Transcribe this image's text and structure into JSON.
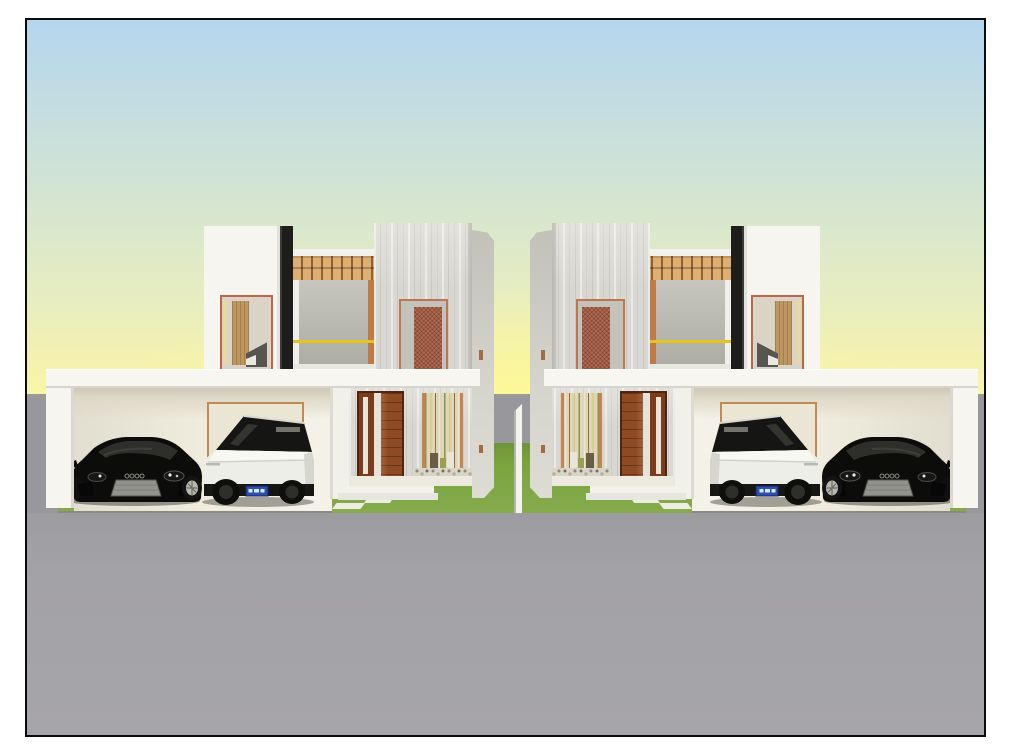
{
  "scene": {
    "type": "3d-architectural-render",
    "description": "Front elevation render of two mirrored modern two-storey duplex houses with flat-roof carports; each carport shelters a black sports car and a white angular truck; green front lawns with white pavers, grey road, gradient sky.",
    "labels": {
      "page": "architectural render viewport",
      "house_left": "left duplex house",
      "house_right": "right duplex house (mirrored)",
      "carport": "carport with flat roof",
      "car_black": "black sports car",
      "car_white": "white angular truck with blue license plate",
      "fence": "thin white dividing wall between lots",
      "lawn": "front lawn",
      "road": "grey road and driveway",
      "sky": "gradient sky from blue to yellow",
      "front_door": "reddish-brown wooden entry door with frosted sidelight",
      "bamboo_niche": "bamboo planter niche with pebble bed",
      "balcony": "first-floor balcony with timber pergola and yellow railing",
      "mesh_door": "terracotta perforated screen door",
      "bedroom_window": "upper window showing interior with wooden door and bed"
    },
    "palette": {
      "sky_top": "#b5d6ef",
      "sky_horizon": "#faf6a6",
      "ground_far": "#98979b",
      "road": "#a3a2a6",
      "lawn": "#7ba43e",
      "wall_white": "#f6f5f0",
      "concrete": "#d8d7d1",
      "roof_slab": "#f7f6f1",
      "door_wood": "#8e4a22",
      "pergola_wood": "#dfae72",
      "accent_orange": "#c0744f",
      "railing_yellow": "#e4c41f",
      "mesh_door": "#b26b52",
      "carport_interior_left": "#efebdc",
      "carport_interior_right": "#c5c6b9",
      "column_black": "#1d1d1c",
      "car_black": "#0c0c0b",
      "car_white": "#eeeee8",
      "plate_blue": "#2a4fae",
      "frame_border": "#0a0a0a"
    }
  }
}
